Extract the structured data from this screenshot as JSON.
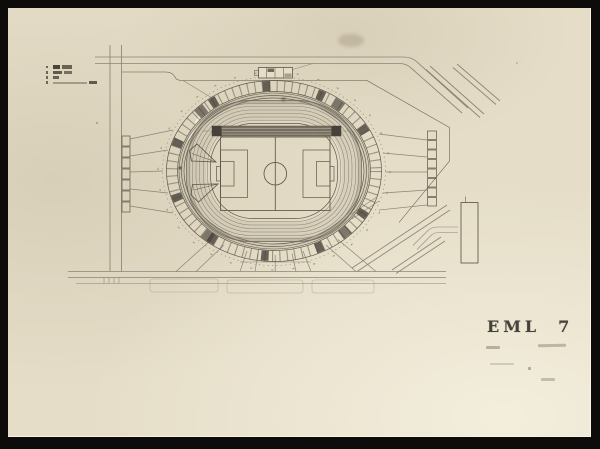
{
  "meta": {
    "title": "Archival photograph of a stadium site plan drawing",
    "plate_label": "EML",
    "plate_number": "7"
  },
  "colors": {
    "frame": "#0d0c0a",
    "paper": "#e5ddc7",
    "paper_light": "#eee8d7",
    "paper_edge": "#f3eedd",
    "ink": "#5e5749",
    "ink_light": "#8c8476",
    "stand_block": "#46413a",
    "band": "#6e6759",
    "label": "#45423b",
    "smudge": "#8d8371"
  }
}
